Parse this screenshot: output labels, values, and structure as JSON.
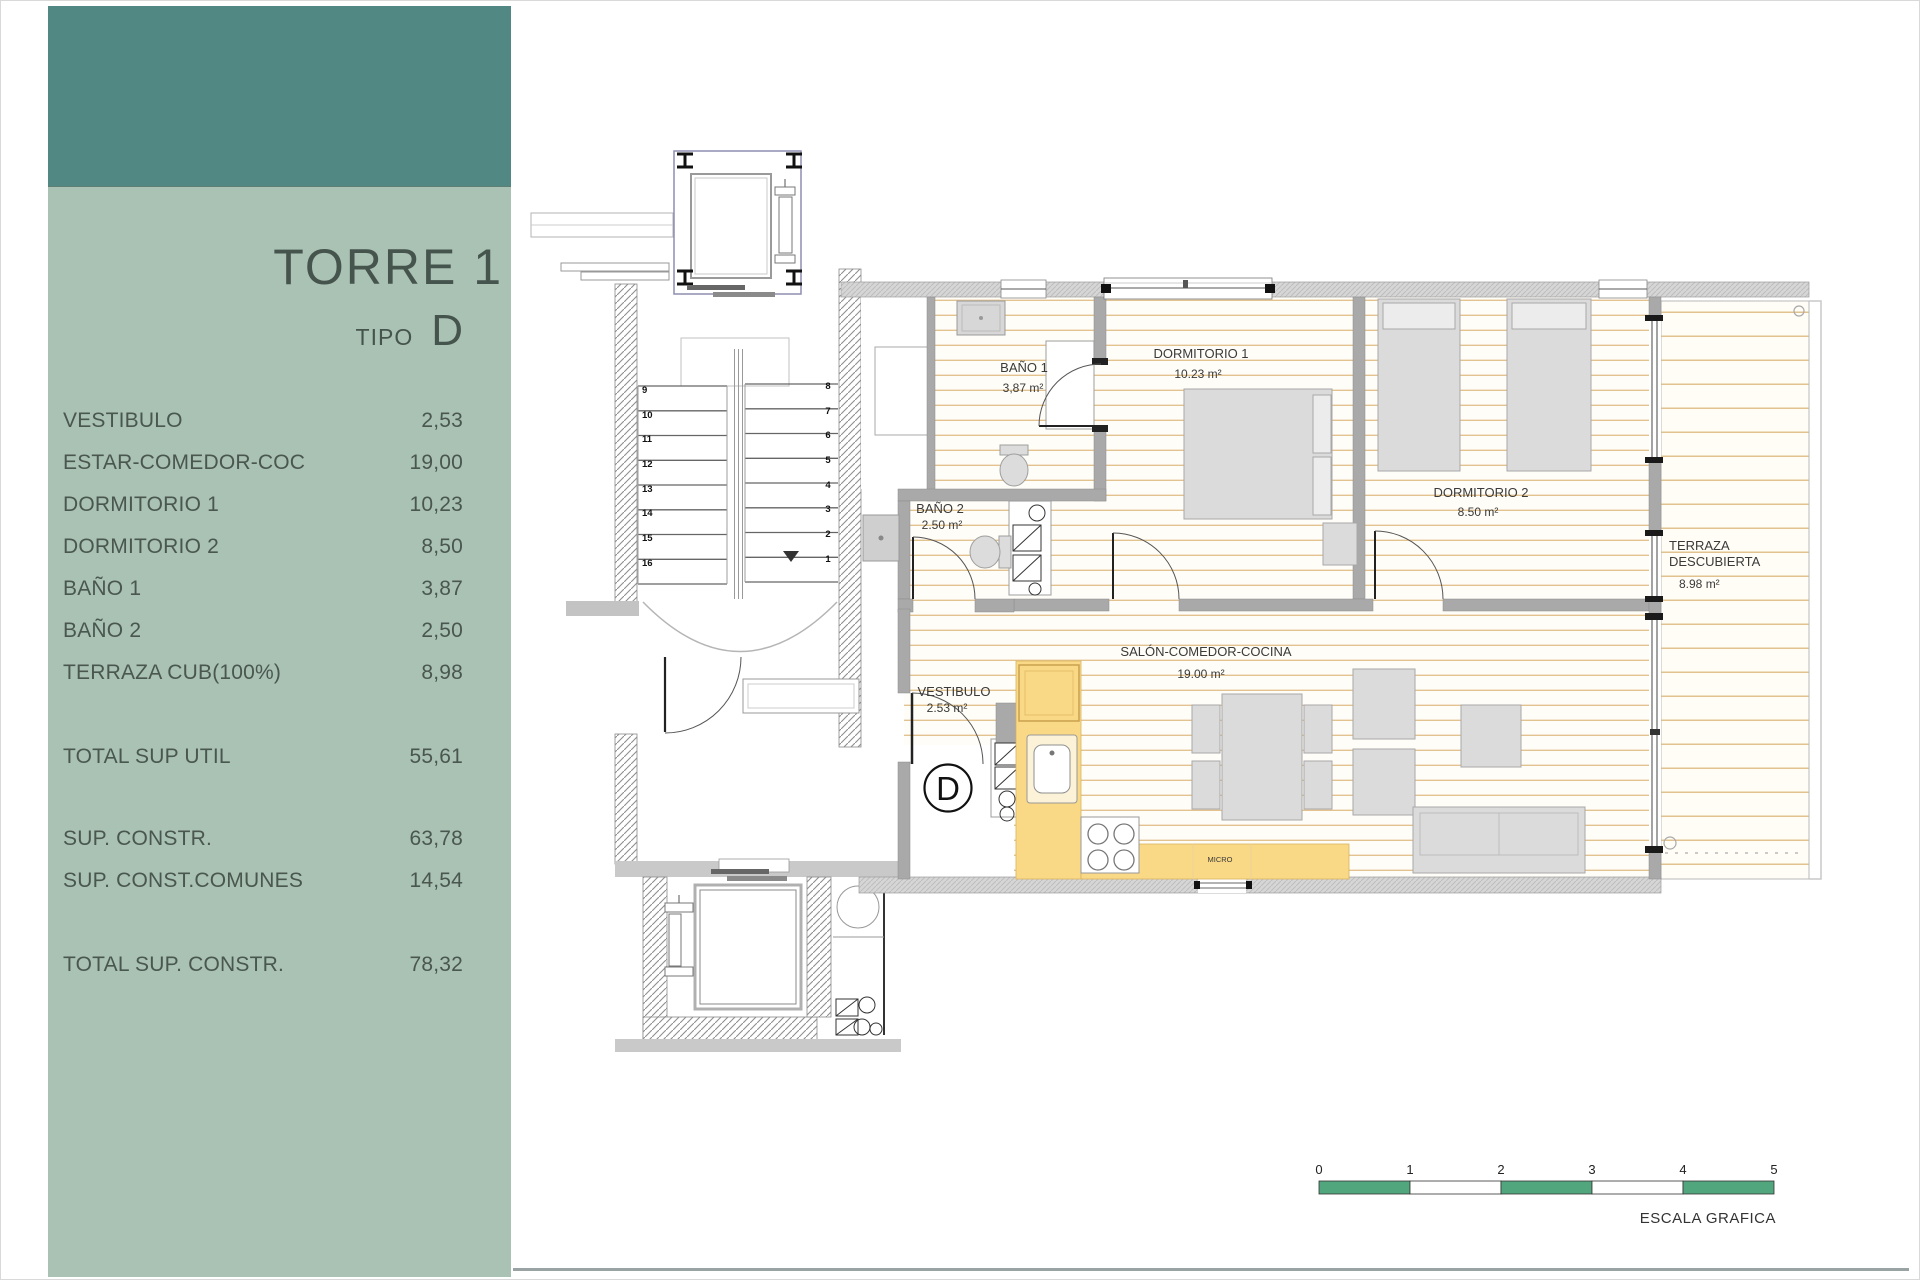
{
  "sidebar": {
    "title": "TORRE 1",
    "tipo_label": "TIPO",
    "tipo_value": "D",
    "rooms": [
      {
        "label": "VESTIBULO",
        "value": "2,53"
      },
      {
        "label": "ESTAR-COMEDOR-COC",
        "value": "19,00"
      },
      {
        "label": "DORMITORIO 1",
        "value": "10,23"
      },
      {
        "label": "DORMITORIO 2",
        "value": "8,50"
      },
      {
        "label": "BAÑO 1",
        "value": "3,87"
      },
      {
        "label": "BAÑO 2",
        "value": "2,50"
      },
      {
        "label": "TERRAZA CUB(100%)",
        "value": "8,98"
      }
    ],
    "totals": [
      {
        "label": "TOTAL SUP UTIL",
        "value": "55,61"
      },
      {
        "label": "SUP. CONSTR.",
        "value": "63,78"
      },
      {
        "label": "SUP. CONST.COMUNES",
        "value": "14,54"
      },
      {
        "label": "TOTAL SUP. CONSTR.",
        "value": "78,32"
      }
    ]
  },
  "plan": {
    "marker": "D",
    "rooms": {
      "bano1": {
        "name": "BAÑO 1",
        "area": "3,87 m²"
      },
      "dorm1": {
        "name": "DORMITORIO 1",
        "area": "10.23 m²"
      },
      "dorm2": {
        "name": "DORMITORIO 2",
        "area": "8.50 m²"
      },
      "bano2": {
        "name": "BAÑO 2",
        "area": "2.50 m²"
      },
      "vestibulo": {
        "name": "VESTIBULO",
        "area": "2.53 m²"
      },
      "salon": {
        "name": "SALÓN-COMEDOR-COCINA",
        "area": "19.00 m²"
      },
      "terraza": {
        "line1": "TERRAZA",
        "line2": "DESCUBIERTA",
        "area": "8.98 m²"
      }
    },
    "kitchen": {
      "micro": "MICRO"
    },
    "stairs": {
      "right": [
        "8",
        "7",
        "6",
        "5",
        "4",
        "3",
        "2",
        "1"
      ],
      "left": [
        "9",
        "10",
        "11",
        "12",
        "13",
        "14",
        "15",
        "16"
      ]
    },
    "scale_bar": {
      "ticks": [
        "0",
        "1",
        "2",
        "3",
        "4",
        "5"
      ],
      "caption": "ESCALA GRAFICA"
    }
  },
  "colors": {
    "header_teal": "#518884",
    "panel_green": "#A9C2B4",
    "sidebar_text": "#4A574F",
    "kitchen_yellow": "#F9D886",
    "floor_stripe": "#E2C28F",
    "wall_gray": "#A9A9A9",
    "scale_green": "#52A67D"
  }
}
